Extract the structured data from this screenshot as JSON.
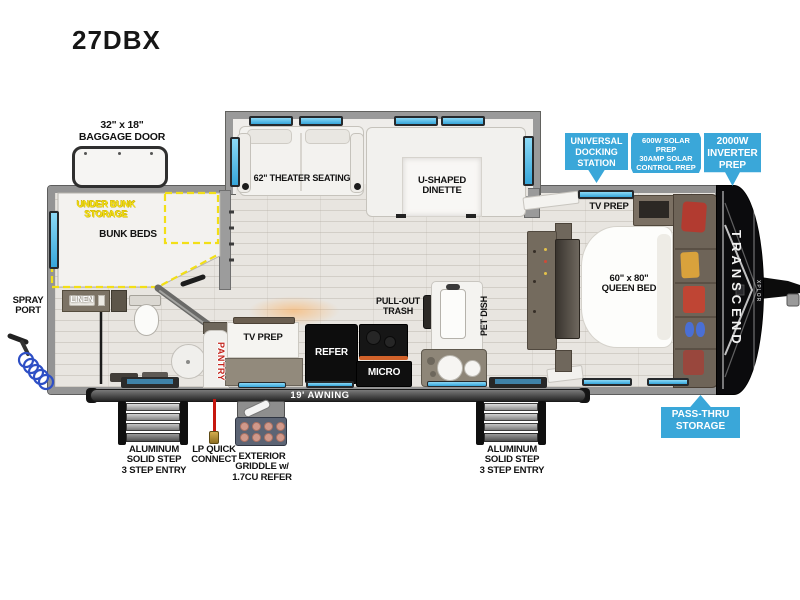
{
  "title": "27DBX",
  "colors": {
    "badge_blue": "#3AA7D9",
    "dash_yellow": "#F2DF17",
    "pantry_red": "#C3241C",
    "window_blue": "#56C2EE",
    "cap_black": "#0B0B0D",
    "lp_red": "#C6170F",
    "hose_blue": "#2E4FC5"
  },
  "rooms": {
    "theater": "62\" THEATER SEATING",
    "dinette": [
      "U-SHAPED",
      "DINETTE"
    ],
    "under_bunk": [
      "UNDER BUNK",
      "STORAGE"
    ],
    "bunk_beds": "BUNK BEDS",
    "linen": "LINEN",
    "pantry": "PANTRY",
    "tv_prep_kitchen": "TV PREP",
    "refer": "REFER",
    "micro": "MICRO",
    "pull_out_trash": [
      "PULL-OUT",
      "TRASH"
    ],
    "pet_dish": "PET DISH",
    "tv_prep_bedroom": "TV PREP",
    "queen_bed": [
      "60\" x 80\"",
      "QUEEN BED"
    ]
  },
  "badges": {
    "docking": [
      "UNIVERSAL",
      "DOCKING",
      "STATION"
    ],
    "solar": [
      "600W SOLAR PREP",
      "30AMP SOLAR",
      "CONTROL PREP"
    ],
    "inverter": [
      "2000W",
      "INVERTER",
      "PREP"
    ],
    "passthru": [
      "PASS-THRU",
      "STORAGE"
    ]
  },
  "exterior": {
    "baggage_door": [
      "32\" x 18\"",
      "BAGGAGE DOOR"
    ],
    "spray_port": [
      "SPRAY",
      "PORT"
    ],
    "awning": "19' AWNING",
    "step_entry": [
      "ALUMINUM",
      "SOLID STEP",
      "3 STEP ENTRY"
    ],
    "lp_connect": [
      "LP QUICK",
      "CONNECT"
    ],
    "griddle": [
      "EXTERIOR",
      "GRIDDLE w/",
      "1.7CU REFER"
    ],
    "brand": "TRANSCEND",
    "brand_sub": "XPLOR"
  }
}
